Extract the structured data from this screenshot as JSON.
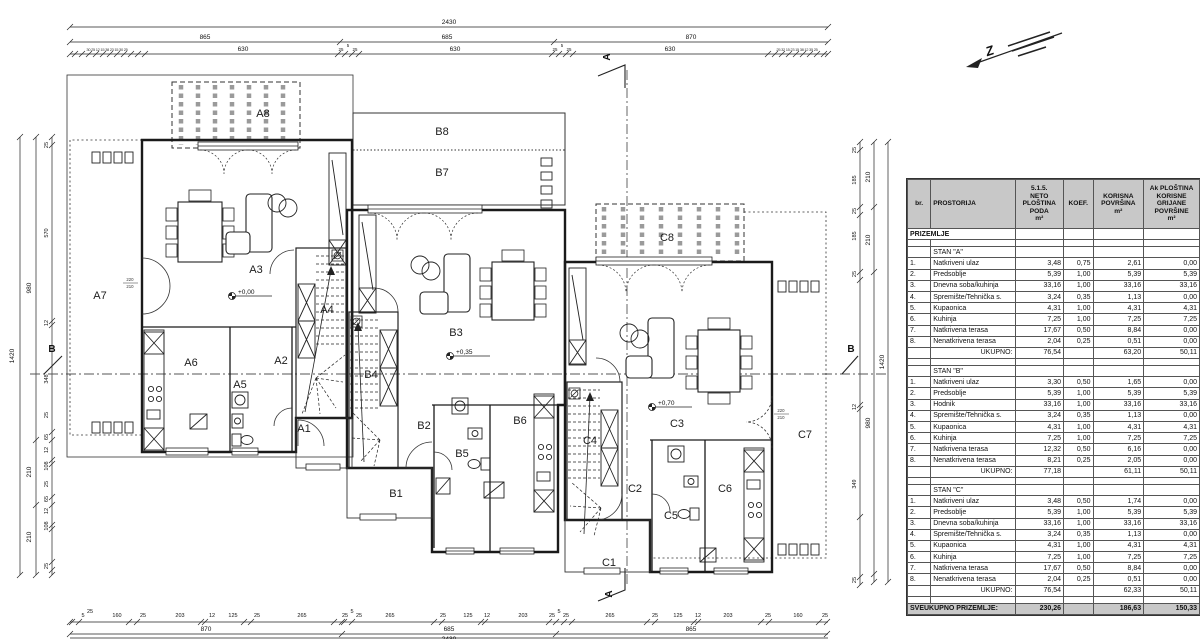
{
  "plan": {
    "rooms": {
      "a1": "A1",
      "a2": "A2",
      "a3": "A3",
      "a4": "A4",
      "a5": "A5",
      "a6": "A6",
      "a7": "A7",
      "a8": "A8",
      "b1": "B1",
      "b2": "B2",
      "b3": "B3",
      "b4": "B4",
      "b5": "B5",
      "b6": "B6",
      "b7": "B7",
      "b8": "B8",
      "c1": "C1",
      "c2": "C2",
      "c3": "C3",
      "c4": "C4",
      "c5": "C5",
      "c6": "C6",
      "c7": "C7",
      "c8": "C8"
    },
    "levels": {
      "a": "+0,00",
      "b": "+0,35",
      "c": "+0,70"
    },
    "sections": {
      "a_top": "A",
      "a_bottom": "A",
      "b_left": "B",
      "b_right": "B"
    },
    "north_label": "Z",
    "door_tags": {
      "a7": [
        "220",
        "210"
      ],
      "c3": [
        "220",
        "210"
      ]
    }
  },
  "dims": {
    "top": {
      "total": "2430",
      "subtotals": [
        "865",
        "685",
        "870"
      ],
      "bays": [
        "630",
        "630",
        "630"
      ],
      "mid_cluster": [
        "25",
        "5",
        "25",
        "25",
        "5",
        "25"
      ],
      "cluster_left": "30 25 12 15 38 23 15 30 25",
      "cluster_right": "25 32 15 23 15 38 12 35 25"
    },
    "bottom": {
      "total": "2430",
      "subtotals": [
        "870",
        "685",
        "865"
      ],
      "segs": [
        "5",
        "25",
        "160",
        "25",
        "203",
        "12",
        "125",
        "25",
        "265",
        "25",
        "5",
        "25",
        "265",
        "25",
        "125",
        "12",
        "203",
        "25",
        "5",
        "25",
        "265",
        "25",
        "125",
        "12",
        "203",
        "25",
        "160",
        "25"
      ]
    },
    "left": {
      "total": "1420",
      "subtotals": [
        "980",
        "210",
        "210"
      ],
      "segs": [
        "25",
        "570",
        "12",
        "348",
        "25",
        "65",
        "12",
        "108",
        "25",
        "65",
        "12",
        "108",
        "25"
      ]
    },
    "right": {
      "total": "1420",
      "subtotals": [
        "210",
        "210",
        "980"
      ],
      "segs": [
        "25",
        "185",
        "25",
        "185",
        "25",
        "12",
        "349",
        "25"
      ]
    }
  },
  "table": {
    "col_headers": {
      "c1": "br.",
      "c2": "PROSTORIJA",
      "c3": [
        "5.1.5.",
        "NETO",
        "PLOŠTINA",
        "PODA",
        "m²"
      ],
      "c4": [
        "KOEF."
      ],
      "c5": [
        "KORISNA",
        "POVRŠINA",
        "m²"
      ],
      "c6": [
        "Ak PLOŠTINA",
        "KORISNE",
        "GRIJANE",
        "POVRŠINE",
        "m²"
      ]
    },
    "floor_label": "PRIZEMLJE",
    "sections": [
      {
        "title": "STAN \"A\"",
        "rows": [
          [
            "1.",
            "Natkriveni ulaz",
            "3,48",
            "0,75",
            "2,61",
            "0,00"
          ],
          [
            "2.",
            "Predsoblje",
            "5,39",
            "1,00",
            "5,39",
            "5,39"
          ],
          [
            "3.",
            "Dnevna soba/kuhinja",
            "33,16",
            "1,00",
            "33,16",
            "33,16"
          ],
          [
            "4.",
            "Spremište/Tehnička s.",
            "3,24",
            "0,35",
            "1,13",
            "0,00"
          ],
          [
            "5.",
            "Kupaonica",
            "4,31",
            "1,00",
            "4,31",
            "4,31"
          ],
          [
            "6.",
            "Kuhinja",
            "7,25",
            "1,00",
            "7,25",
            "7,25"
          ],
          [
            "7.",
            "Natkrivena terasa",
            "17,67",
            "0,50",
            "8,84",
            "0,00"
          ],
          [
            "8.",
            "Nenatkrivena terasa",
            "2,04",
            "0,25",
            "0,51",
            "0,00"
          ]
        ],
        "total_label": "UKUPNO:",
        "totals": [
          "76,54",
          "",
          "63,20",
          "50,11"
        ]
      },
      {
        "title": "STAN \"B\"",
        "rows": [
          [
            "1.",
            "Natkriveni ulaz",
            "3,30",
            "0,50",
            "1,65",
            "0,00"
          ],
          [
            "2.",
            "Predsoblje",
            "5,39",
            "1,00",
            "5,39",
            "5,39"
          ],
          [
            "3.",
            "Hodnik",
            "33,16",
            "1,00",
            "33,16",
            "33,16"
          ],
          [
            "4.",
            "Spremište/Tehnička s.",
            "3,24",
            "0,35",
            "1,13",
            "0,00"
          ],
          [
            "5.",
            "Kupaonica",
            "4,31",
            "1,00",
            "4,31",
            "4,31"
          ],
          [
            "6.",
            "Kuhinja",
            "7,25",
            "1,00",
            "7,25",
            "7,25"
          ],
          [
            "7.",
            "Natkrivena terasa",
            "12,32",
            "0,50",
            "6,16",
            "0,00"
          ],
          [
            "8.",
            "Nenatkrivena terasa",
            "8,21",
            "0,25",
            "2,05",
            "0,00"
          ]
        ],
        "total_label": "UKUPNO:",
        "totals": [
          "77,18",
          "",
          "61,11",
          "50,11"
        ]
      },
      {
        "title": "STAN \"C\"",
        "rows": [
          [
            "1.",
            "Natkriveni ulaz",
            "3,48",
            "0,50",
            "1,74",
            "0,00"
          ],
          [
            "2.",
            "Predsoblje",
            "5,39",
            "1,00",
            "5,39",
            "5,39"
          ],
          [
            "3.",
            "Dnevna soba/kuhinja",
            "33,16",
            "1,00",
            "33,16",
            "33,16"
          ],
          [
            "4.",
            "Spremište/Tehnička s.",
            "3,24",
            "0,35",
            "1,13",
            "0,00"
          ],
          [
            "5.",
            "Kupaonica",
            "4,31",
            "1,00",
            "4,31",
            "4,31"
          ],
          [
            "6.",
            "Kuhinja",
            "7,25",
            "1,00",
            "7,25",
            "7,25"
          ],
          [
            "7.",
            "Natkrivena terasa",
            "17,67",
            "0,50",
            "8,84",
            "0,00"
          ],
          [
            "8.",
            "Nenatkrivena terasa",
            "2,04",
            "0,25",
            "0,51",
            "0,00"
          ]
        ],
        "total_label": "UKUPNO:",
        "totals": [
          "76,54",
          "",
          "62,33",
          "50,11"
        ]
      }
    ],
    "grand_label": "SVEUKUPNO PRIZEMLJE:",
    "grand_totals": [
      "230,26",
      "",
      "186,63",
      "150,33"
    ]
  }
}
